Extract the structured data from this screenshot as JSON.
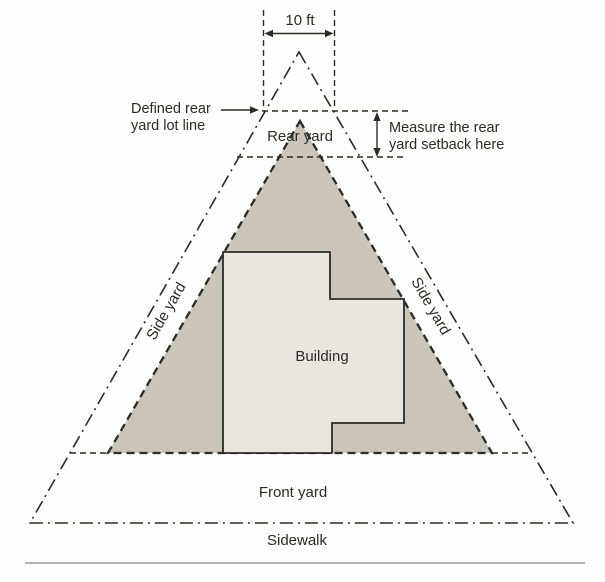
{
  "diagram": {
    "colors": {
      "background": "#fdfdfb",
      "line": "#2d2b28",
      "text": "#2d2b28",
      "side_yard_shade": "#cbc4b8",
      "building_fill": "#e9e6e0",
      "ground_line": "#8a8a8a"
    },
    "dimension_label": "10 ft",
    "annotations": {
      "defined_rear": {
        "line1": "Defined rear",
        "line2": "yard lot line"
      },
      "measure_setback": {
        "line1": "Measure the rear",
        "line2": "yard setback here"
      }
    },
    "areas": {
      "rear_yard": "Rear yard",
      "side_yard_left": "Side yard",
      "side_yard_right": "Side yard",
      "building": "Building",
      "front_yard": "Front yard",
      "sidewalk": "Sidewalk"
    }
  }
}
